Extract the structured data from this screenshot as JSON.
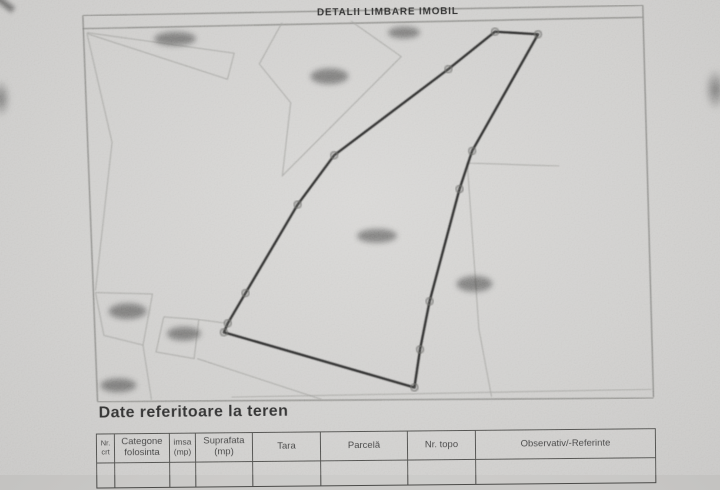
{
  "document": {
    "title": "DETALII LIMBARE IMOBIL",
    "section_heading": "Date referitoare la teren"
  },
  "colors": {
    "paper": "#cac9c7",
    "ink": "#222220",
    "boundary_line": "#242422",
    "faint_line": "#9a9a96",
    "frame_line": "#6e6e6a",
    "table_line": "#4a4a48",
    "redaction_blob": "#2f2f2d",
    "vertex_marker": "#636361"
  },
  "map": {
    "frame_lines": [
      [
        [
          85,
          13
        ],
        [
          645,
          8
        ]
      ],
      [
        [
          85,
          26
        ],
        [
          645,
          20
        ]
      ],
      [
        [
          85,
          13
        ],
        [
          96,
          399
        ]
      ],
      [
        [
          645,
          8
        ],
        [
          652,
          400
        ]
      ],
      [
        [
          96,
          399
        ],
        [
          652,
          401
        ]
      ]
    ],
    "boundary_polygon": [
      [
        497,
        33
      ],
      [
        540,
        36
      ],
      [
        473,
        152
      ],
      [
        460,
        190
      ],
      [
        429,
        302
      ],
      [
        419,
        350
      ],
      [
        413,
        388
      ],
      [
        223,
        331
      ],
      [
        227,
        322
      ],
      [
        245,
        292
      ],
      [
        298,
        204
      ],
      [
        335,
        155
      ],
      [
        450,
        70
      ]
    ],
    "vertex_markers": [
      [
        497,
        33
      ],
      [
        540,
        36
      ],
      [
        473,
        152
      ],
      [
        460,
        190
      ],
      [
        429,
        302
      ],
      [
        419,
        350
      ],
      [
        413,
        388
      ],
      [
        223,
        331
      ],
      [
        227,
        322
      ],
      [
        245,
        292
      ],
      [
        298,
        204
      ],
      [
        335,
        155
      ],
      [
        450,
        70
      ]
    ],
    "background_lines": [
      [
        [
          89,
          30
        ],
        [
          236,
          52
        ],
        [
          229,
          78
        ],
        [
          89,
          31
        ]
      ],
      [
        [
          89,
          31
        ],
        [
          113,
          140
        ],
        [
          95,
          288
        ]
      ],
      [
        [
          284,
          22
        ],
        [
          261,
          63
        ],
        [
          292,
          102
        ],
        [
          283,
          175
        ],
        [
          403,
          57
        ],
        [
          353,
          21
        ]
      ],
      [
        [
          468,
          164
        ],
        [
          560,
          168
        ]
      ],
      [
        [
          468,
          164
        ],
        [
          478,
          330
        ],
        [
          490,
          398
        ]
      ],
      [
        [
          95,
          290
        ],
        [
          152,
          292
        ],
        [
          142,
          343
        ],
        [
          103,
          333
        ],
        [
          95,
          290
        ]
      ],
      [
        [
          163,
          315
        ],
        [
          198,
          318
        ],
        [
          193,
          357
        ],
        [
          155,
          350
        ],
        [
          163,
          315
        ]
      ],
      [
        [
          142,
          343
        ],
        [
          150,
          398
        ]
      ],
      [
        [
          196,
          357
        ],
        [
          320,
          399
        ]
      ],
      [
        [
          198,
          318
        ],
        [
          226,
          322
        ]
      ],
      [
        [
          230,
          396
        ],
        [
          650,
          392
        ]
      ]
    ],
    "redacted_labels": [
      {
        "cx": 177,
        "cy": 37,
        "rx": 21,
        "ry": 7
      },
      {
        "cx": 331,
        "cy": 76,
        "rx": 19,
        "ry": 8
      },
      {
        "cx": 406,
        "cy": 33,
        "rx": 16,
        "ry": 6
      },
      {
        "cx": 377,
        "cy": 236,
        "rx": 20,
        "ry": 7
      },
      {
        "cx": 474,
        "cy": 285,
        "rx": 18,
        "ry": 8
      },
      {
        "cx": 127,
        "cy": 309,
        "rx": 19,
        "ry": 8
      },
      {
        "cx": 183,
        "cy": 332,
        "rx": 17,
        "ry": 7
      },
      {
        "cx": 117,
        "cy": 383,
        "rx": 18,
        "ry": 7
      }
    ]
  },
  "table": {
    "columns": [
      {
        "line1": "Nr.",
        "line2": "crt",
        "width": 18,
        "font": 7.5
      },
      {
        "line1": "Categone",
        "line2": "folosinta",
        "width": 55,
        "font": 9.5
      },
      {
        "line1": "imsa",
        "line2": "(mp)",
        "width": 26,
        "font": 8.5
      },
      {
        "line1": "Suprafata",
        "line2": "(mp)",
        "width": 57,
        "font": 9.5
      },
      {
        "line1": "Tara",
        "line2": "",
        "width": 68,
        "font": 9.5
      },
      {
        "line1": "Parcelă",
        "line2": "",
        "width": 87,
        "font": 9.5
      },
      {
        "line1": "Nr. topo",
        "line2": "",
        "width": 68,
        "font": 9.5
      },
      {
        "line1": "Observativ/-Referinte",
        "line2": "",
        "width": 179,
        "font": 9.5
      }
    ]
  }
}
